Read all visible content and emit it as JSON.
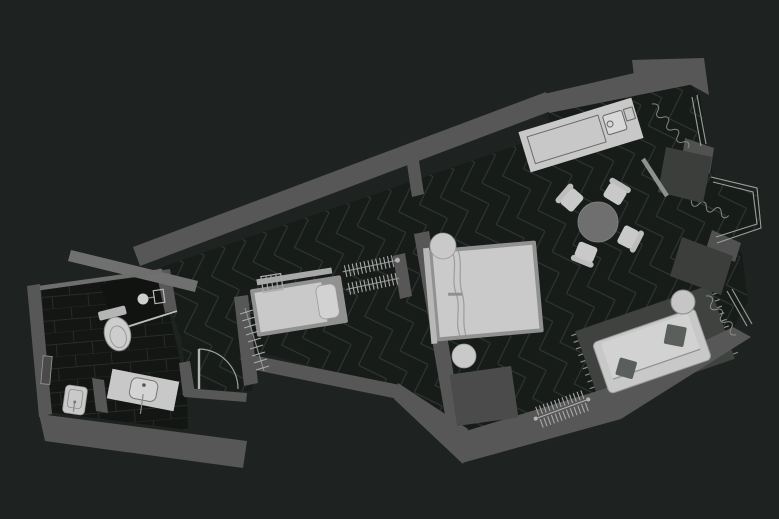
{
  "meta": {
    "title": "Dark-theme apartment floor plan, top-down view, no visible text labels"
  },
  "colors": {
    "background": "#1e2220",
    "floor": "#181c19",
    "floor_pattern_line": "#2e3933",
    "bath_floor": "#131613",
    "bath_tile_line": "#272c27",
    "wall": "#575757",
    "wall_light": "#707070",
    "wall_stub": "#515151",
    "furniture_light": "#c8c8c8",
    "furniture_frame": "#919191",
    "furniture_dark_block": "#3b3e3b",
    "bench": "#4b4b4b",
    "rug": "#3f423f",
    "table_top": "#6f6f6f",
    "pillow": "#5b5f5b",
    "radiator": "#b5b5b5",
    "shower_glass": "#b9beb9",
    "window_line": "#9aa09b"
  },
  "scene": {
    "rooms": [
      {
        "id": "bathroom",
        "features": [
          "toilet",
          "shower",
          "vanity-sink",
          "washbasin",
          "towel-niche"
        ]
      },
      {
        "id": "hallway",
        "features": [
          "entry-door",
          "coat-rack"
        ]
      },
      {
        "id": "sleeping-alcove",
        "features": [
          "single-bed",
          "ladder-radiator",
          "open-wardrobe-hangers"
        ]
      },
      {
        "id": "bedroom",
        "features": [
          "double-bed",
          "nightstand-round",
          "nightstand-round",
          "bench"
        ]
      },
      {
        "id": "kitchen",
        "features": [
          "island-with-sink"
        ]
      },
      {
        "id": "living-dining",
        "features": [
          "round-dining-table",
          "four-chairs",
          "sofa",
          "rug",
          "side-table",
          "tv-console",
          "radiator"
        ]
      }
    ],
    "window_count": 3,
    "bay_window": true,
    "door_count": 2,
    "radiator_count": 2
  }
}
